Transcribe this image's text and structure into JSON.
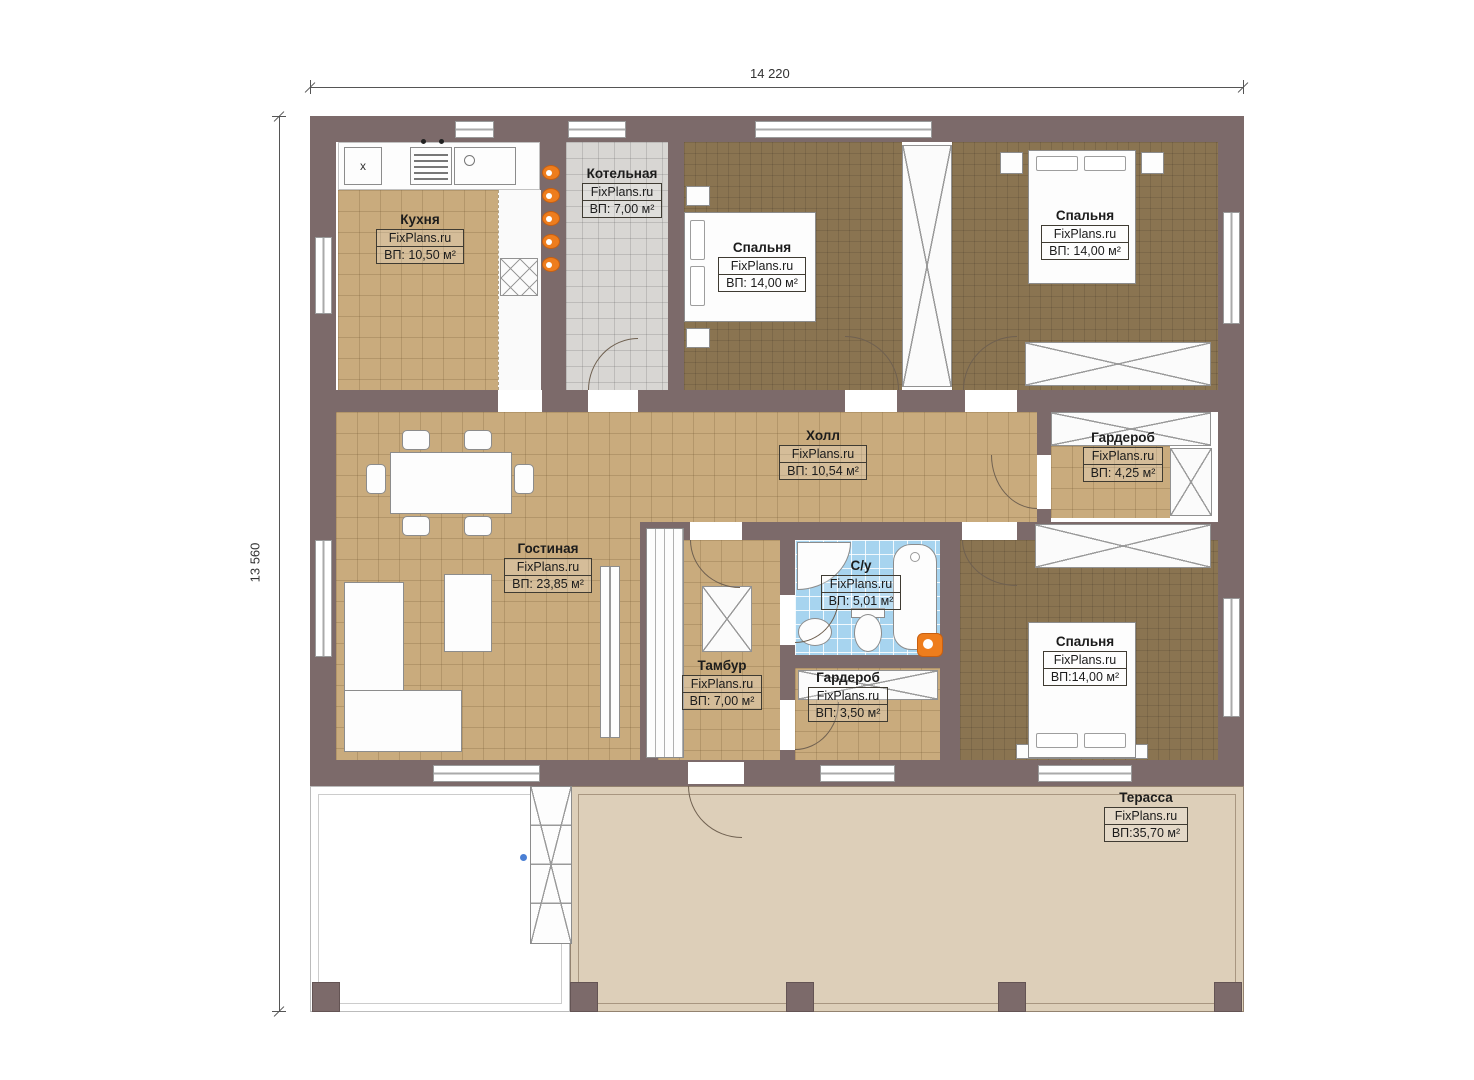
{
  "dimensions": {
    "width": "14 220",
    "height": "13 560"
  },
  "rooms": [
    {
      "name": "Кухня",
      "brand": "FixPlans.ru",
      "area": "ВП: 10,50 м²"
    },
    {
      "name": "Котельная",
      "brand": "FixPlans.ru",
      "area": "ВП: 7,00 м²"
    },
    {
      "name": "Спальня",
      "brand": "FixPlans.ru",
      "area": "ВП: 14,00 м²"
    },
    {
      "name": "Спальня",
      "brand": "FixPlans.ru",
      "area": "ВП: 14,00 м²"
    },
    {
      "name": "Холл",
      "brand": "FixPlans.ru",
      "area": "ВП: 10,54 м²"
    },
    {
      "name": "Гардероб",
      "brand": "FixPlans.ru",
      "area": "ВП: 4,25 м²"
    },
    {
      "name": "Гостиная",
      "brand": "FixPlans.ru",
      "area": "ВП: 23,85 м²"
    },
    {
      "name": "С/у",
      "brand": "FixPlans.ru",
      "area": "ВП: 5,01 м²"
    },
    {
      "name": "Тамбур",
      "brand": "FixPlans.ru",
      "area": "ВП: 7,00 м²"
    },
    {
      "name": "Гардероб",
      "brand": "FixPlans.ru",
      "area": "ВП: 3,50 м²"
    },
    {
      "name": "Спальня",
      "brand": "FixPlans.ru",
      "area": "ВП:14,00 м²"
    },
    {
      "name": "Терасса",
      "brand": "FixPlans.ru",
      "area": "ВП:35,70 м²"
    }
  ],
  "markers": {
    "kitchen_appliance": "x"
  },
  "colors": {
    "wall": "#7c6a6a",
    "tile_tan": "#c9ab7d",
    "carpet_brown": "#8a7451",
    "tile_gray": "#d8d6d3",
    "tile_blue": "#a7d4ef",
    "terrace": "#ddcfb9",
    "accent_orange": "#ee7d1d"
  }
}
